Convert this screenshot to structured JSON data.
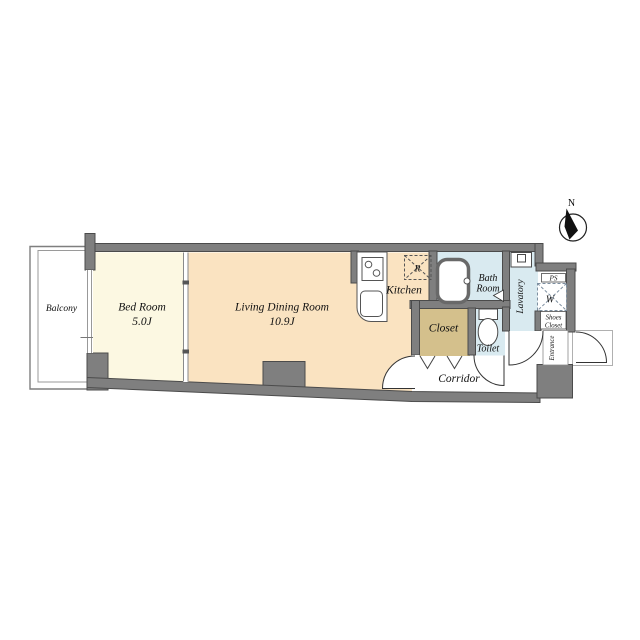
{
  "title": "apartment-floor-plan",
  "colors": {
    "bedroom_floor": "#fcf8e2",
    "living_floor": "#fae3c1",
    "closet_floor": "#d4c08c",
    "water_room_floor": "#d9eaf0",
    "wall_fill": "#7f7f7f",
    "white": "#ffffff"
  },
  "rooms": {
    "balcony": {
      "label": "Balcony"
    },
    "bedroom": {
      "label": "Bed Room",
      "size": "5.0J"
    },
    "living": {
      "label": "Living Dining Room",
      "size": "10.9J"
    },
    "kitchen": {
      "label": "Kitchen"
    },
    "refrigerator": {
      "label": "R"
    },
    "bath": {
      "line1": "Bath",
      "line2": "Room"
    },
    "lavatory": {
      "label": "Lavatory"
    },
    "toilet": {
      "label": "Toilet"
    },
    "closet": {
      "label": "Closet"
    },
    "corridor": {
      "label": "Corridor"
    },
    "pipe_space": {
      "label": "PS"
    },
    "washer": {
      "label": "W"
    },
    "shoes_closet": {
      "line1": "Shoes",
      "line2": "Closet"
    },
    "entrance": {
      "label": "Entrance"
    }
  },
  "compass": {
    "label": "N"
  }
}
